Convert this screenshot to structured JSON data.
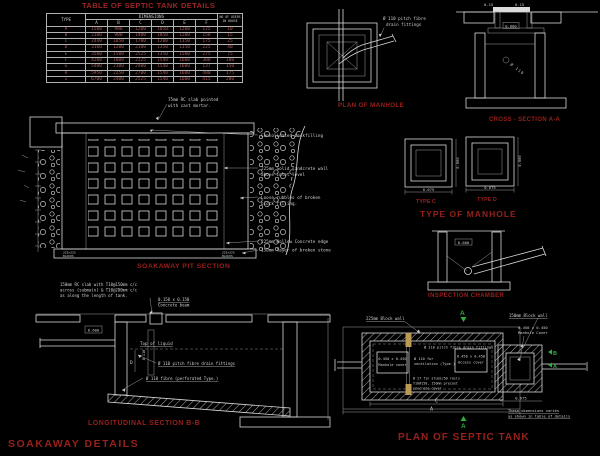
{
  "main_title": "SOAKAWAY  DETAILS",
  "table": {
    "title": "TABLE OF SEPTIC TANK DETAILS",
    "col_type": "TYPE",
    "col_dimensions": "DIMENSIONS",
    "col_users_line1": "NO OF USERS",
    "col_users_line2": "IN HOUSE",
    "dim_headers": [
      "A",
      "B",
      "C",
      "D",
      "E",
      "F"
    ],
    "rows": [
      {
        "type": "A",
        "a": "1500",
        "b": "900",
        "c": "1200",
        "d": "1050",
        "e": "1200",
        "f": "125",
        "users": "10"
      },
      {
        "type": "B",
        "a": "2100",
        "b": "900",
        "c": "1400",
        "d": "1050",
        "e": "1200",
        "f": "150",
        "users": "15"
      },
      {
        "type": "C",
        "a": "2440",
        "b": "1050",
        "c": "1700",
        "d": "1200",
        "e": "1350",
        "f": "175",
        "users": "25"
      },
      {
        "type": "D",
        "a": "3160",
        "b": "1200",
        "c": "2100",
        "d": "1350",
        "e": "1350",
        "f": "225",
        "users": "40"
      },
      {
        "type": "E",
        "a": "3500",
        "b": "1500",
        "c": "2525",
        "d": "1350",
        "e": "1500",
        "f": "275",
        "users": "75"
      },
      {
        "type": "F",
        "a": "4200",
        "b": "1800",
        "c": "2225",
        "d": "1540",
        "e": "1600",
        "f": "300",
        "users": "100"
      },
      {
        "type": "G",
        "a": "5400",
        "b": "2100",
        "c": "2400",
        "d": "1540",
        "e": "1600",
        "f": "137",
        "users": "150"
      },
      {
        "type": "H",
        "a": "5950",
        "b": "2250",
        "c": "2700",
        "d": "1540",
        "e": "1600",
        "f": "400",
        "users": "175"
      },
      {
        "type": "I",
        "a": "6700",
        "b": "2400",
        "c": "2525",
        "d": "1540",
        "e": "1600",
        "f": "415",
        "users": "200"
      }
    ]
  },
  "plan_manhole": {
    "note_line1": "Ø 110 pitch fibre",
    "note_line2": "drain fittings",
    "caption": "PLAN OF MANHOLE"
  },
  "cross_section": {
    "dim_left": "0.15",
    "dim_right": "0.15",
    "dim_inner": "0.600",
    "pipe_label": "Ø 110",
    "caption": "CROSS - SECTION A-A"
  },
  "type_manhole": {
    "title": "TYPE OF MANHOLE",
    "c_caption": "TYPE C",
    "d_caption": "TYPE D",
    "c_dim": "0.675",
    "d_dim": "0.675",
    "c_vdim": "0.600",
    "d_vdim": "0.600"
  },
  "soakaway": {
    "note_slab_1": "75mm RC slab pointed",
    "note_slab_2": "with cast mortar.",
    "note_backfill": "Consolidated backfilling",
    "note_wall_1": "225mm Solid sandcrete wall",
    "note_wall_2": "above inlet level",
    "note_rubble_1": "Loose rubbles of broken",
    "note_rubble_2": "block filling.",
    "note_edge": "225mm Hollow Concrete edge",
    "note_stone": "150mm layer of broken stone",
    "corner_left_1": "225x225",
    "corner_left_2": "BLOCKS",
    "corner_right_1": "225x225",
    "corner_right_2": "BLOCKS",
    "caption": "SOAKAWAY PIT SECTION"
  },
  "inspection": {
    "dim": "0.600",
    "caption": "INSPECTION CHAMBER"
  },
  "longitudinal": {
    "note_slab_1": "150mm RC slab with T10@150mm c/c",
    "note_slab_2": "across (submain) & T10@200mm c/c",
    "note_slab_3": "as along the length of tank.",
    "note_beam_1": "0.150 x 0.150",
    "note_beam_2": "Concrete beam",
    "dim_opening": "0.600",
    "label_liquid": "Top of liquid",
    "note_pipe": "Ø 110 pitch fibre drain fittings",
    "note_perf": "Ø 110 fibre (perforated Type.)",
    "pipe_v_label": "Ø 110",
    "dim_d": "D",
    "caption": "LONGITUDINAL SECTION B-B"
  },
  "plan_septic": {
    "note_wall225": "225mm Block wall",
    "note_wall150": "150mm Block wall",
    "note_cover_1": "0.450 x 0.450",
    "note_cover_2": "Manhole Cover",
    "label_mh1_1": "0.450 x 0.450",
    "label_mh1_2": "Manhole cover",
    "label_vent_1": "Ø 110 for",
    "label_vent_2": "ventilation (Type.)",
    "label_pipe": "Ø 110 pitch fibre drain fittings",
    "label_mh2_1": "0.450 x 0.450",
    "label_mh2_2": "Access cover",
    "label_precast_1": "Ø 27 fin studs/50 rails",
    "label_precast_2": "T10@150, 150mm precast",
    "label_precast_3": "concrete cover",
    "dim_c": "C",
    "dim_a": "A",
    "dim_right": "0.675",
    "marker_top": "A",
    "marker_bottom": "A",
    "marker_right_1": "B",
    "marker_right_2": "A",
    "note_dims_1": "These dimensions varies",
    "note_dims_2": "as shown in table of details",
    "caption": "PLAN OF SEPTIC TANK"
  },
  "colors": {
    "background": "#000000",
    "line": "#d9d9d9",
    "caption_red": "#96201c",
    "section_green": "#2fae3e",
    "pipe_tan": "#b99a55",
    "table_value_red": "#a85a5a"
  }
}
